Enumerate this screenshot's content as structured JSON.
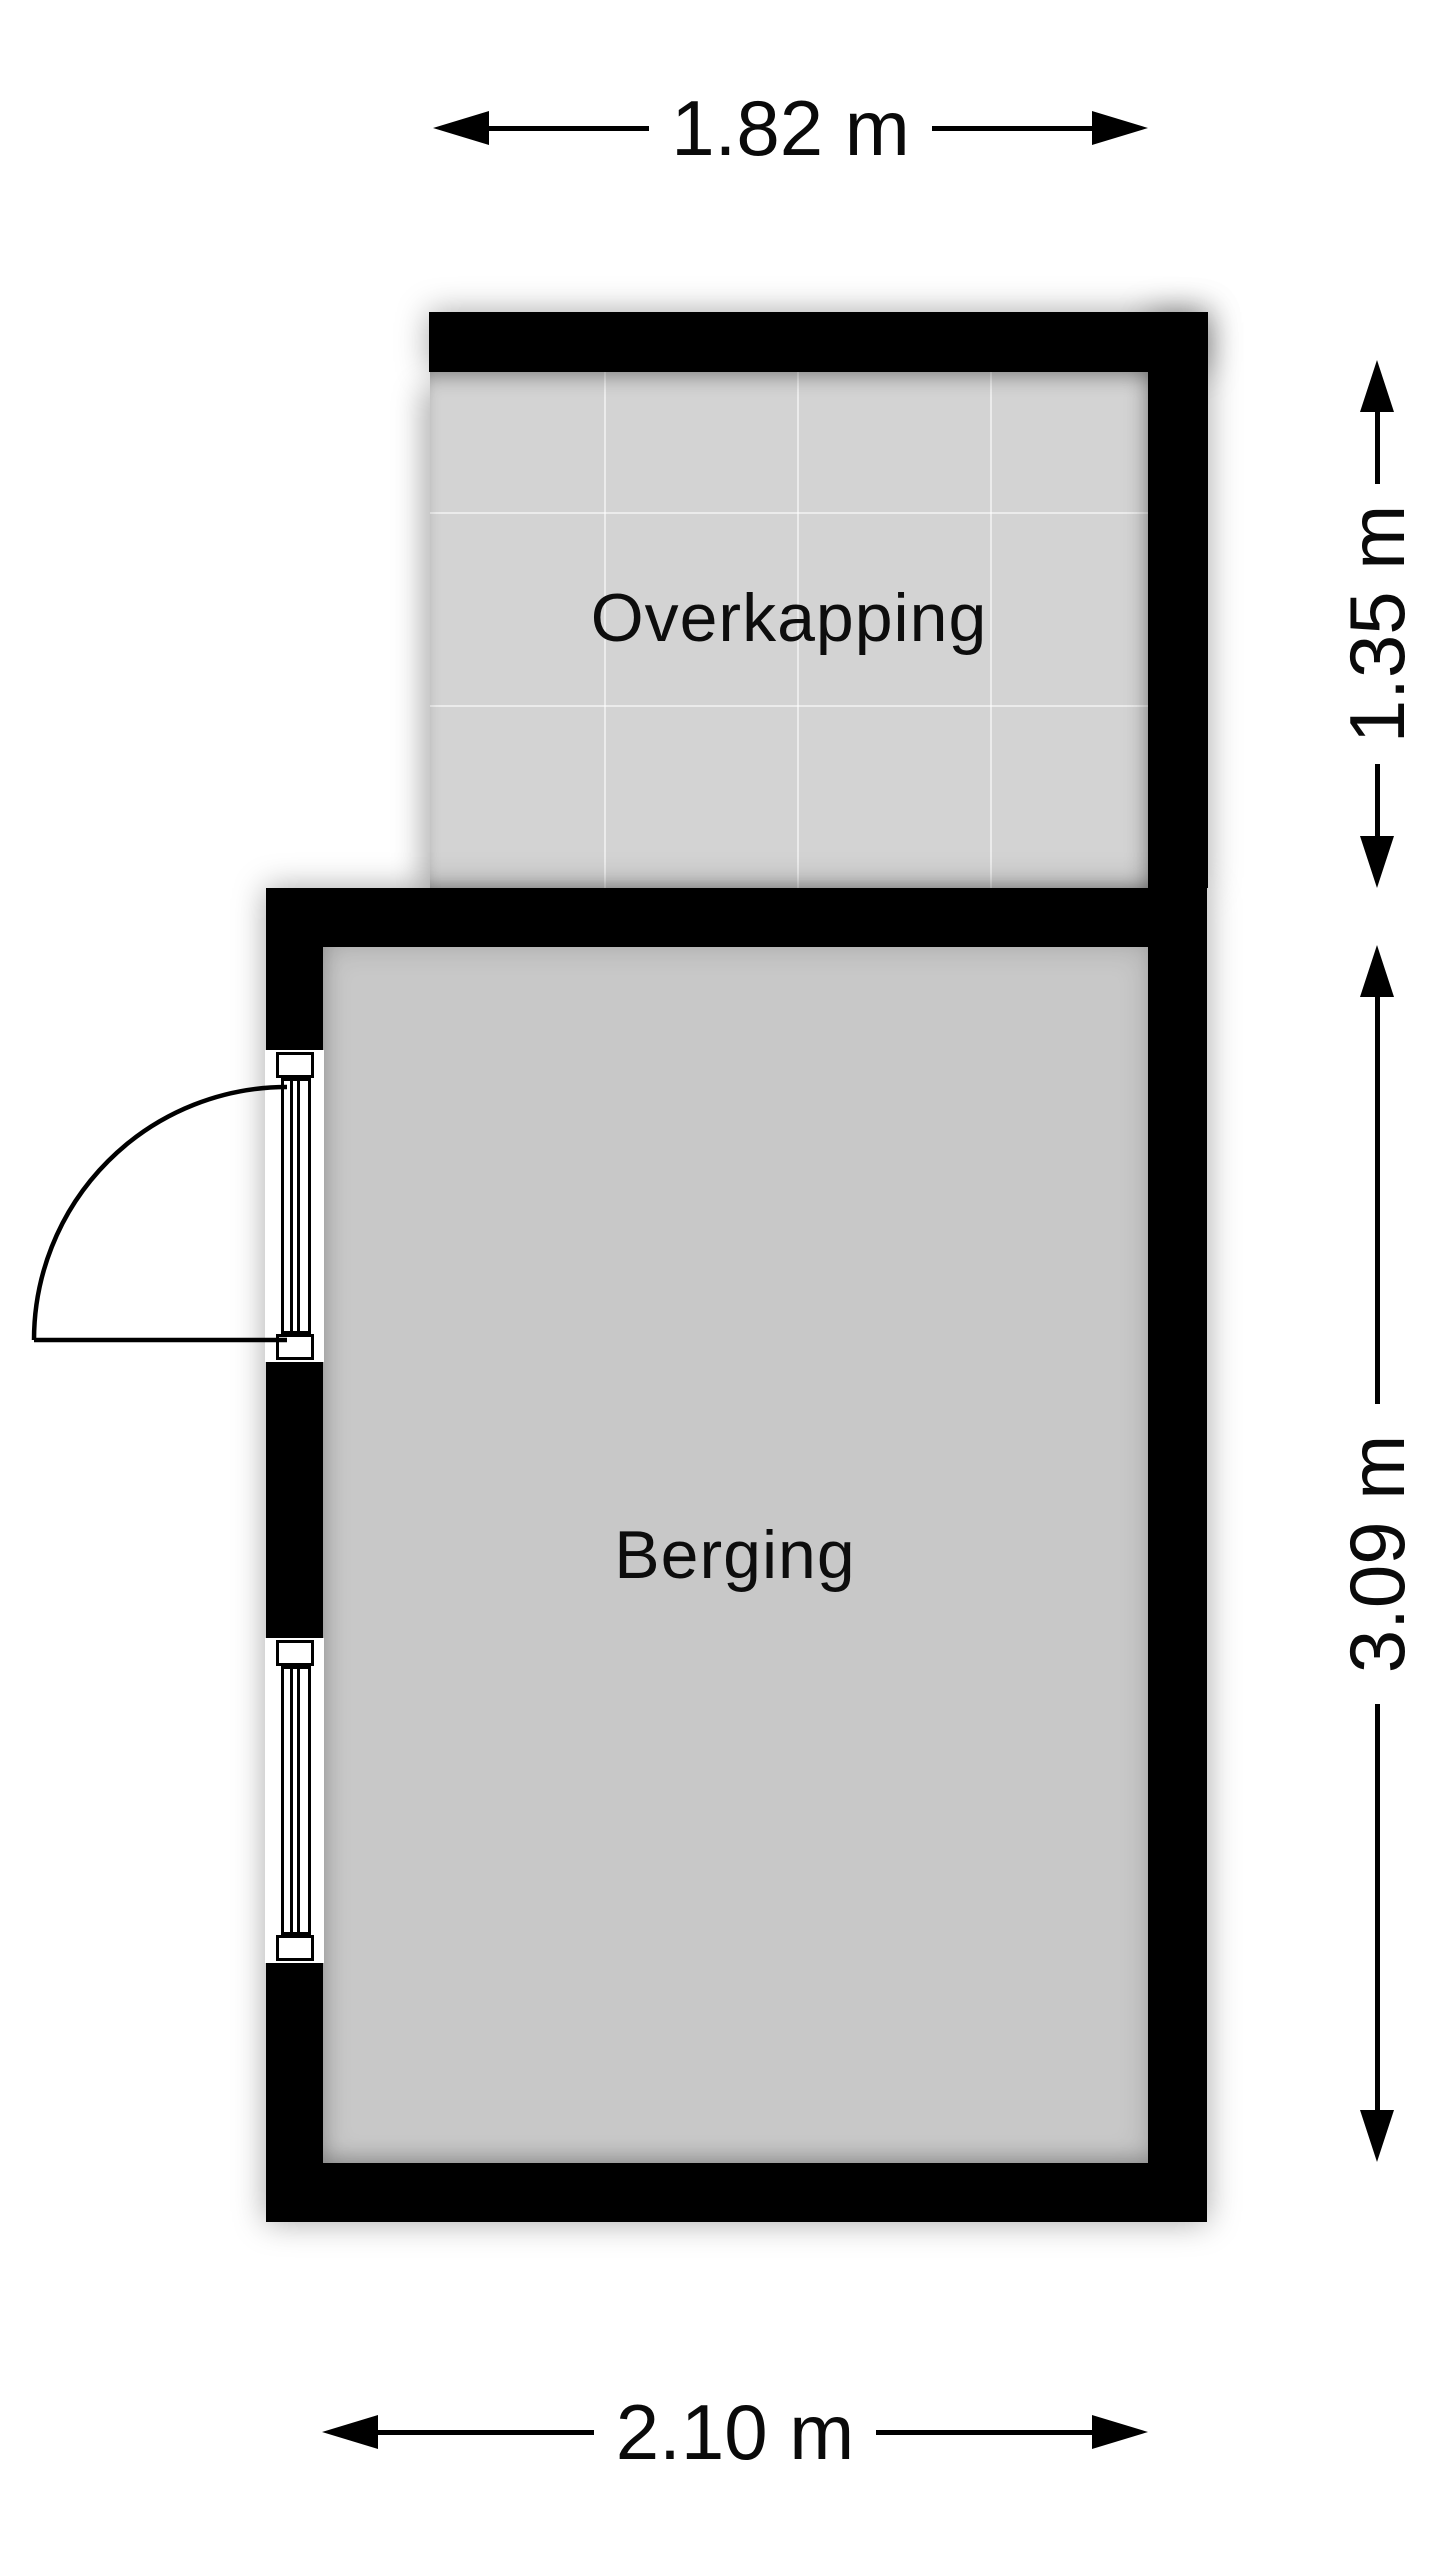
{
  "plan": {
    "title": "Floor plan",
    "rooms": [
      {
        "id": "overkapping",
        "label": "Overkapping"
      },
      {
        "id": "berging",
        "label": "Berging"
      }
    ],
    "dimensions": {
      "top": {
        "label": "1.82 m",
        "edge": "overkapping-width"
      },
      "right_upper": {
        "label": "1.35 m",
        "edge": "overkapping-depth"
      },
      "right_lower": {
        "label": "3.09 m",
        "edge": "berging-depth"
      },
      "bottom": {
        "label": "2.10 m",
        "edge": "berging-width"
      }
    },
    "features": [
      {
        "id": "door",
        "type": "glazed-door-with-swing",
        "wall": "left"
      },
      {
        "id": "window",
        "type": "window",
        "wall": "left"
      }
    ],
    "colors": {
      "wall": "#000000",
      "overkapping_floor": "#d3d3d3",
      "berging_floor": "#c8c8c8",
      "background": "#ffffff",
      "text": "#0a0a0a"
    }
  }
}
